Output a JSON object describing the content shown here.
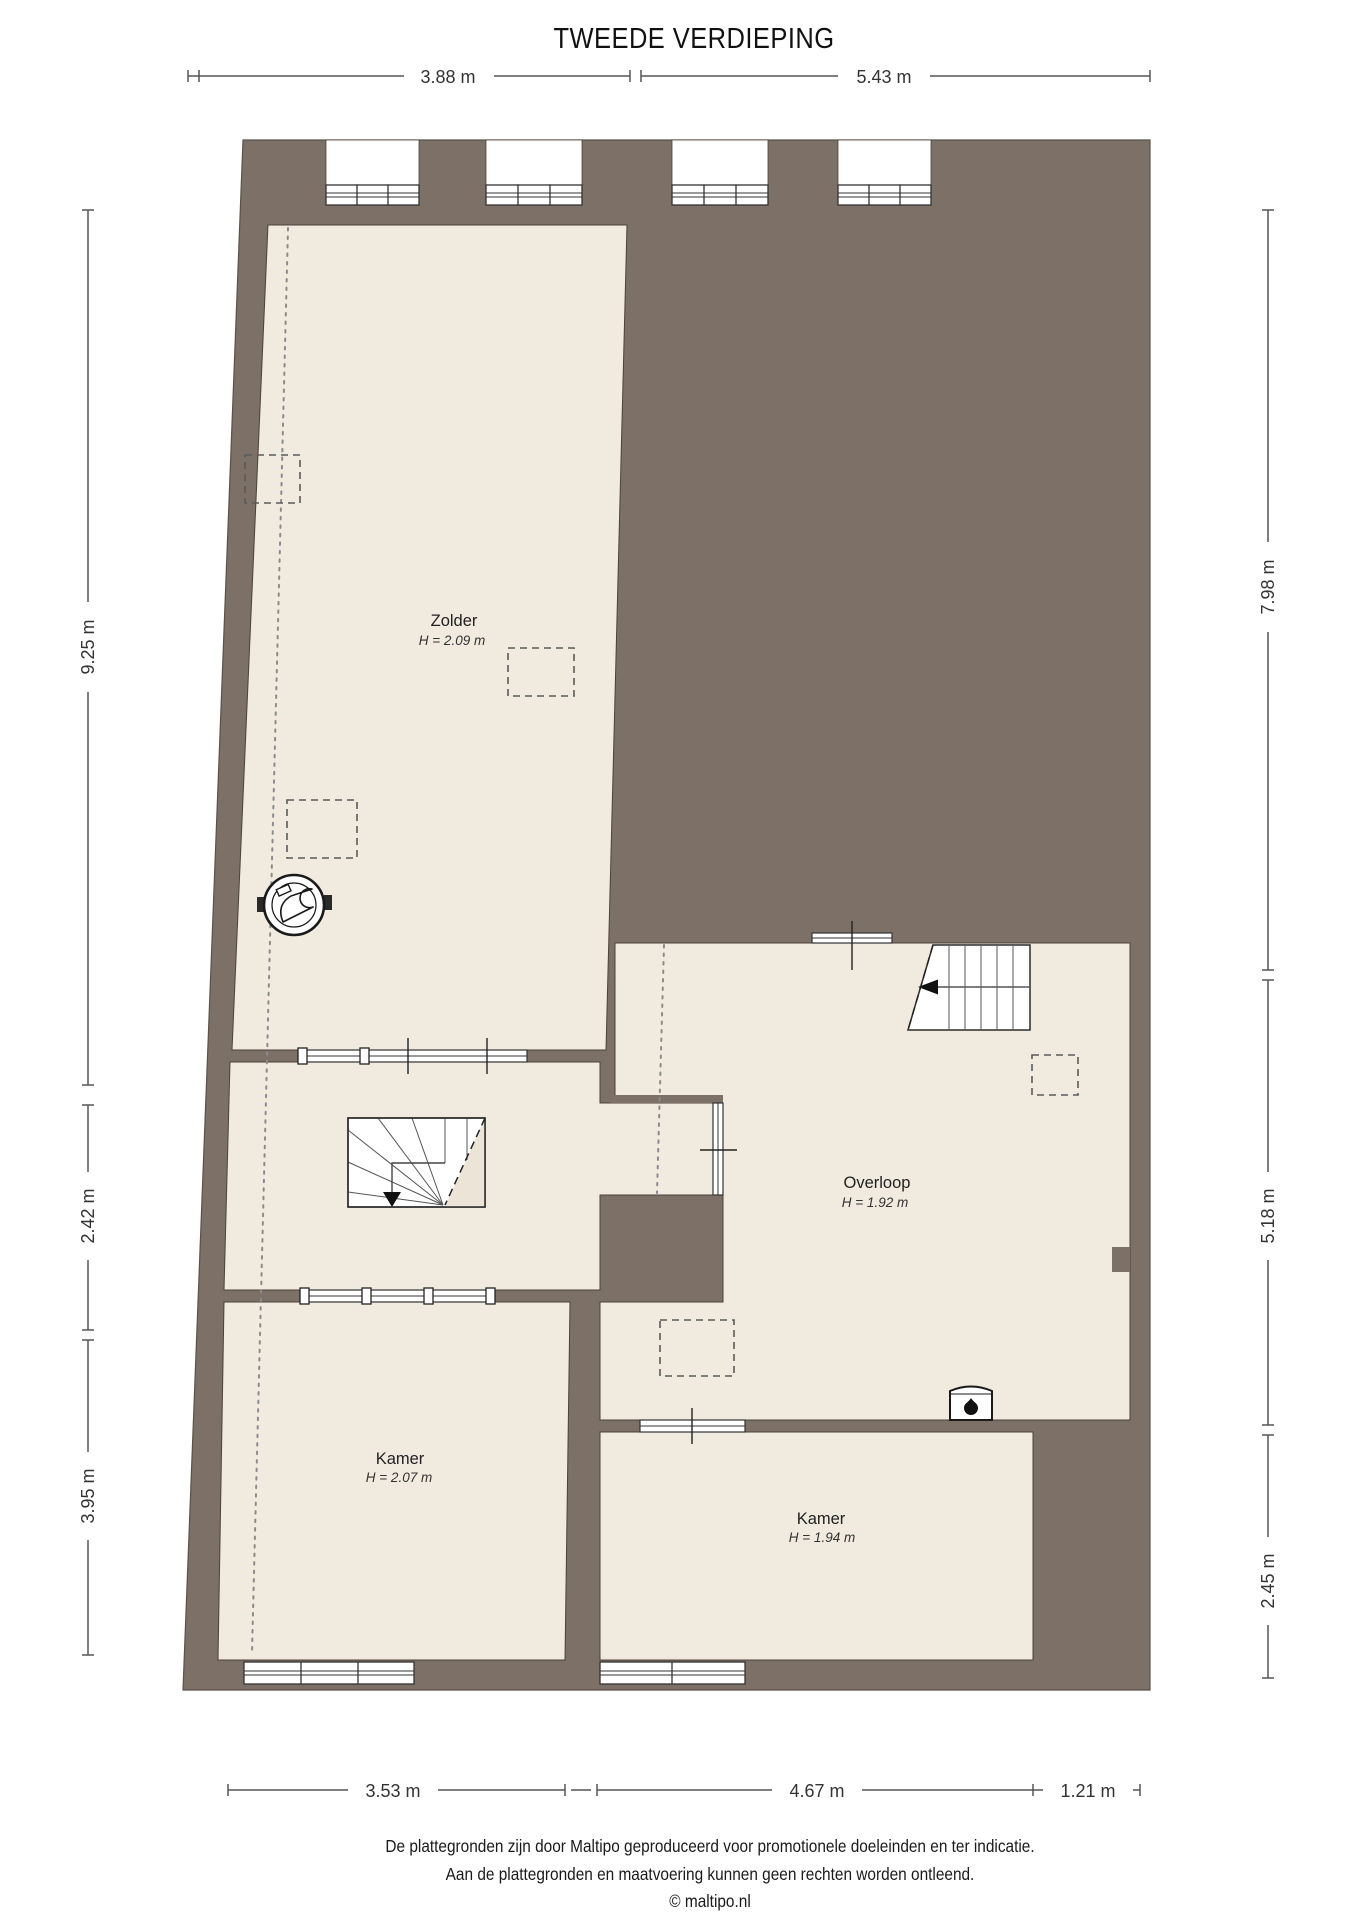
{
  "title": "TWEEDE VERDIEPING",
  "floor_plan": {
    "rooms": [
      {
        "name": "Zolder",
        "height": "H = 2.09 m"
      },
      {
        "name": "Overloop",
        "height": "H = 1.92 m"
      },
      {
        "name": "Kamer",
        "height": "H = 2.07 m"
      },
      {
        "name": "Kamer",
        "height": "H = 1.94 m"
      }
    ],
    "icons": [
      "mechanical-ventilation-icon",
      "wood-stove-icon",
      "staircase-straight-icon",
      "staircase-winder-icon",
      "skylight-dashed-box",
      "window-glazing"
    ],
    "colors": {
      "wall": "#7d7066",
      "floor": "#f0eadf",
      "stair-shade": "#ece4d6",
      "line": "#2b2b2b",
      "dim-line": "#555555"
    }
  },
  "dimensions": {
    "top": [
      "3.88 m",
      "5.43 m"
    ],
    "left": [
      "9.25 m",
      "2.42 m",
      "3.95 m"
    ],
    "right": [
      "7.98 m",
      "5.18 m",
      "2.45 m"
    ],
    "bottom": [
      "3.53 m",
      "4.67 m",
      "1.21 m"
    ]
  },
  "footer": {
    "lines": [
      "De plattegronden zijn door Maltipo geproduceerd voor promotionele doeleinden en ter indicatie.",
      "Aan de plattegronden en maatvoering kunnen geen rechten worden ontleend.",
      "© maltipo.nl"
    ]
  }
}
